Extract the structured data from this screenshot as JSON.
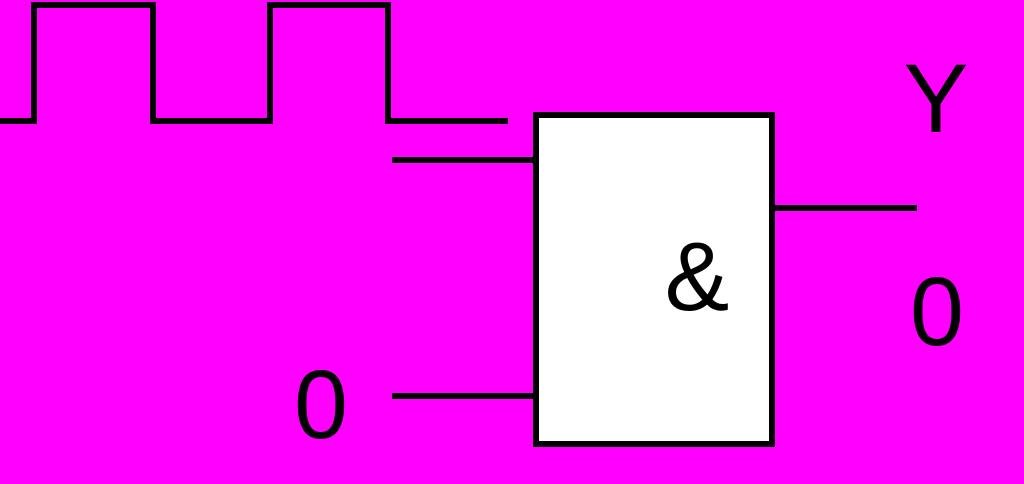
{
  "colors": {
    "background": "#FF00FF",
    "line": "#000000",
    "gate_fill": "#FFFFFF",
    "text": "#000000"
  },
  "gate": {
    "symbol": "&"
  },
  "signals": {
    "input_top": {
      "waveform_pattern": "low-high-low-high-low",
      "waveform_points": "0,121 34,121 34,5 153,5 153,121 270,121 270,5 388,5 388,121 508,121"
    },
    "input_bottom": {
      "value": "0"
    },
    "output": {
      "name": "Y",
      "value": "0"
    }
  }
}
